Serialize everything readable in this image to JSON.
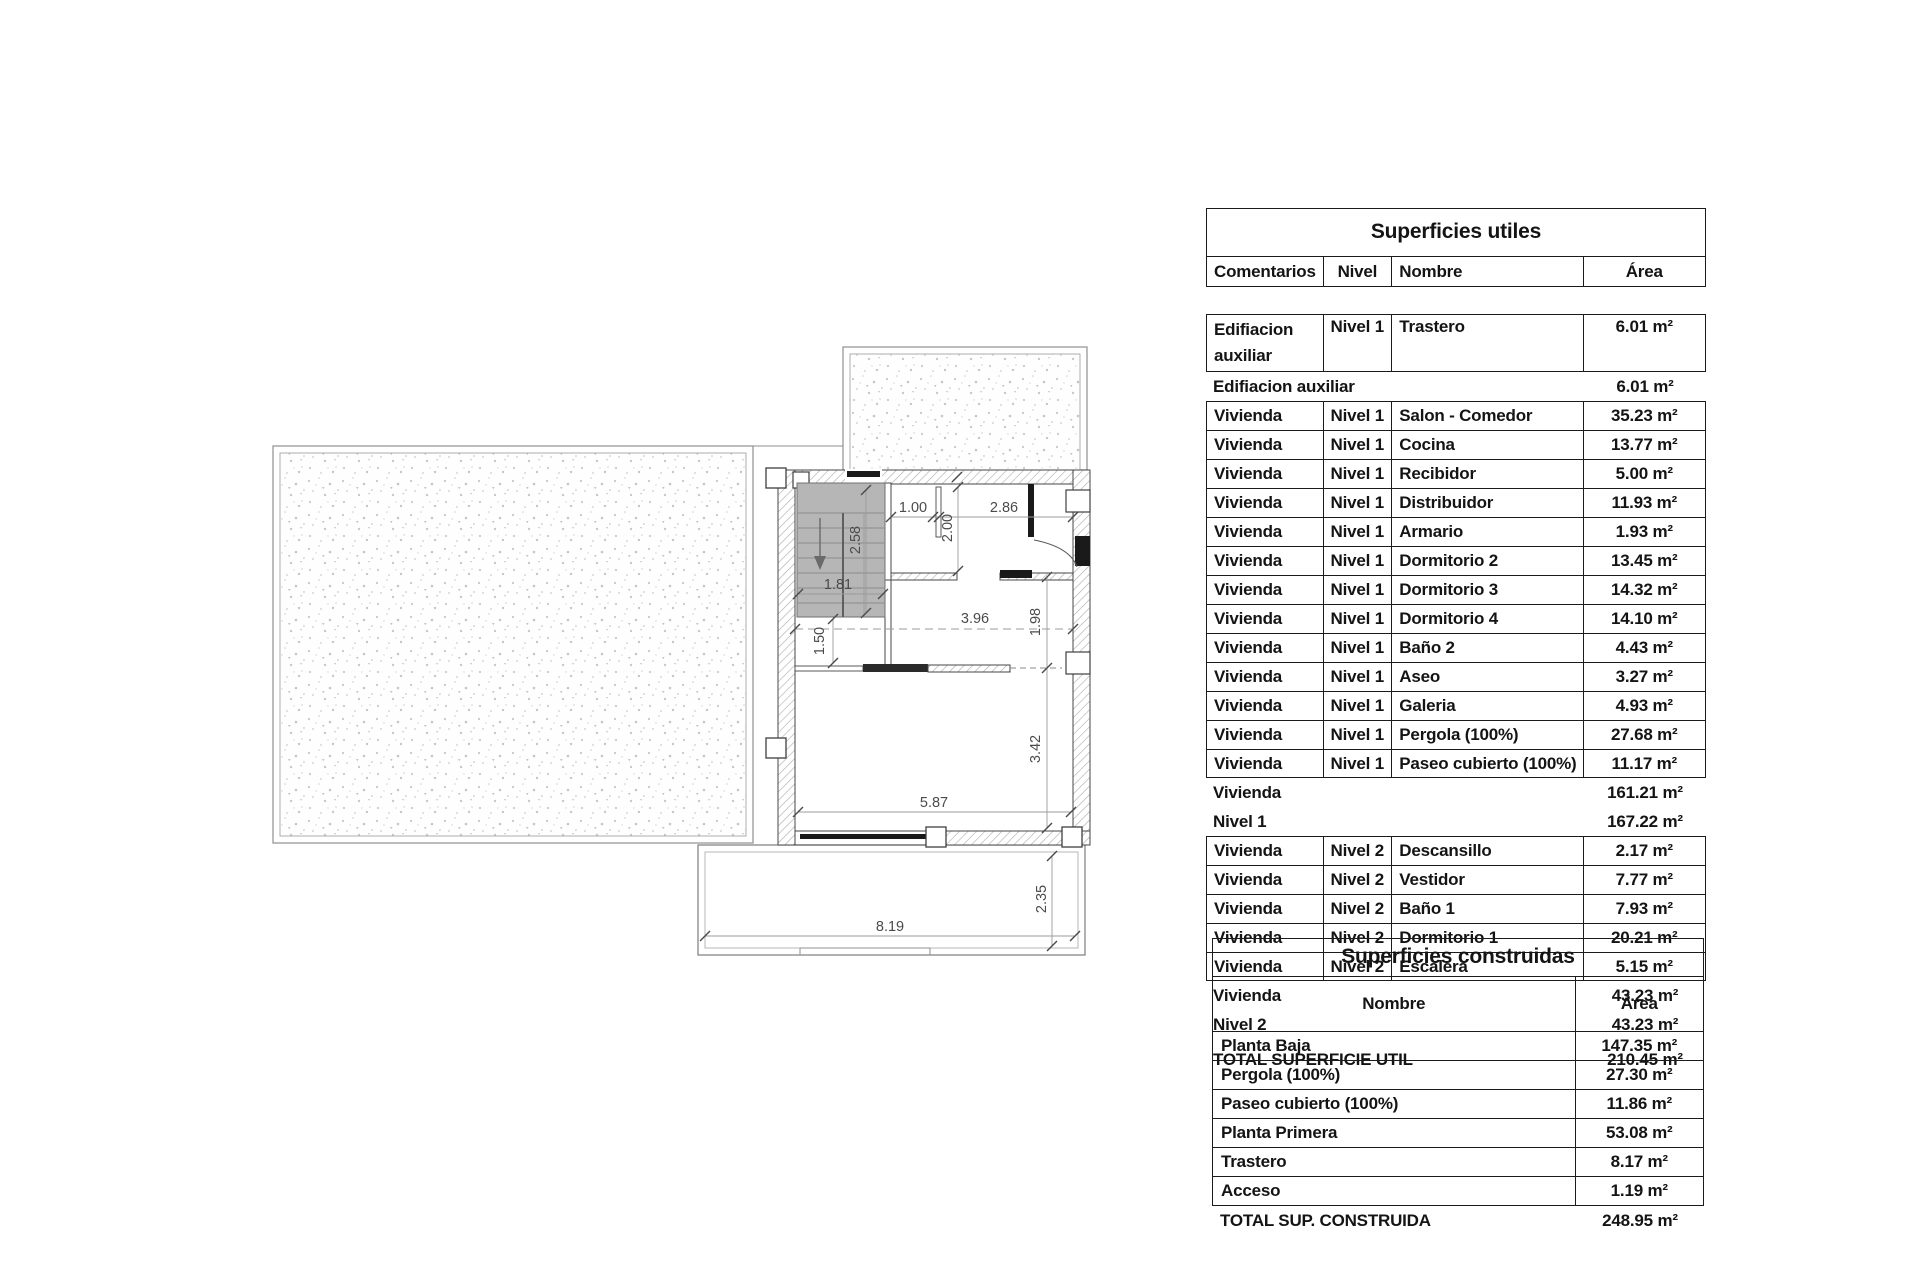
{
  "plan": {
    "dimensions": {
      "closet_width": "1.00",
      "bedroom_width": "2.86",
      "bedroom_depth": "2.00",
      "stair_run": "2.58",
      "stair_width": "1.81",
      "landing_depth": "1.50",
      "hall_width": "3.96",
      "hall_depth": "1.98",
      "salon_depth": "3.42",
      "salon_width": "5.87",
      "porch_width": "8.19",
      "porch_depth": "2.35"
    }
  },
  "tables": {
    "superficies_utiles": {
      "title": "Superficies utiles",
      "columns": [
        "Comentarios",
        "Nivel",
        "Nombre",
        "Área"
      ],
      "rows": [
        {
          "type": "data",
          "tall": true,
          "comentarios": "Edifiacion auxiliar",
          "nivel": "Nivel 1",
          "nombre": "Trastero",
          "area": "6.01 m²"
        },
        {
          "type": "subtotal",
          "label": "Edifiacion auxiliar",
          "area": "6.01 m²"
        },
        {
          "type": "data",
          "comentarios": "Vivienda",
          "nivel": "Nivel 1",
          "nombre": "Salon - Comedor",
          "area": "35.23 m²"
        },
        {
          "type": "data",
          "comentarios": "Vivienda",
          "nivel": "Nivel 1",
          "nombre": "Cocina",
          "area": "13.77 m²"
        },
        {
          "type": "data",
          "comentarios": "Vivienda",
          "nivel": "Nivel 1",
          "nombre": "Recibidor",
          "area": "5.00 m²"
        },
        {
          "type": "data",
          "comentarios": "Vivienda",
          "nivel": "Nivel 1",
          "nombre": "Distribuidor",
          "area": "11.93 m²"
        },
        {
          "type": "data",
          "comentarios": "Vivienda",
          "nivel": "Nivel 1",
          "nombre": "Armario",
          "area": "1.93 m²"
        },
        {
          "type": "data",
          "comentarios": "Vivienda",
          "nivel": "Nivel 1",
          "nombre": "Dormitorio 2",
          "area": "13.45 m²"
        },
        {
          "type": "data",
          "comentarios": "Vivienda",
          "nivel": "Nivel 1",
          "nombre": "Dormitorio 3",
          "area": "14.32 m²"
        },
        {
          "type": "data",
          "comentarios": "Vivienda",
          "nivel": "Nivel 1",
          "nombre": "Dormitorio 4",
          "area": "14.10 m²"
        },
        {
          "type": "data",
          "comentarios": "Vivienda",
          "nivel": "Nivel 1",
          "nombre": "Baño 2",
          "area": "4.43 m²"
        },
        {
          "type": "data",
          "comentarios": "Vivienda",
          "nivel": "Nivel 1",
          "nombre": "Aseo",
          "area": "3.27 m²"
        },
        {
          "type": "data",
          "comentarios": "Vivienda",
          "nivel": "Nivel 1",
          "nombre": "Galeria",
          "area": "4.93 m²"
        },
        {
          "type": "data",
          "comentarios": "Vivienda",
          "nivel": "Nivel 1",
          "nombre": "Pergola (100%)",
          "area": "27.68 m²"
        },
        {
          "type": "data",
          "comentarios": "Vivienda",
          "nivel": "Nivel 1",
          "nombre": "Paseo cubierto (100%)",
          "area": "11.17 m²"
        },
        {
          "type": "subtotal",
          "label": "Vivienda",
          "area": "161.21 m²"
        },
        {
          "type": "subtotal",
          "label": "Nivel 1",
          "area": "167.22 m²"
        },
        {
          "type": "data",
          "comentarios": "Vivienda",
          "nivel": "Nivel 2",
          "nombre": "Descansillo",
          "area": "2.17 m²"
        },
        {
          "type": "data",
          "comentarios": "Vivienda",
          "nivel": "Nivel 2",
          "nombre": "Vestidor",
          "area": "7.77 m²"
        },
        {
          "type": "data",
          "comentarios": "Vivienda",
          "nivel": "Nivel 2",
          "nombre": "Baño 1",
          "area": "7.93 m²"
        },
        {
          "type": "data",
          "comentarios": "Vivienda",
          "nivel": "Nivel 2",
          "nombre": "Dormitorio 1",
          "area": "20.21 m²"
        },
        {
          "type": "data",
          "comentarios": "Vivienda",
          "nivel": "Nivel 2",
          "nombre": "Escalera",
          "area": "5.15 m²"
        },
        {
          "type": "subtotal",
          "label": "Vivienda",
          "area": "43.23 m²"
        },
        {
          "type": "subtotal",
          "label": "Nivel 2",
          "area": "43.23 m²"
        },
        {
          "type": "total",
          "label": "TOTAL SUPERFICIE UTIL",
          "area": "210.45 m²"
        }
      ]
    },
    "superficies_construidas": {
      "title": "Superficies construidas",
      "columns": [
        "Nombre",
        "Área"
      ],
      "rows": [
        {
          "nombre": "Planta Baja",
          "area": "147.35 m²"
        },
        {
          "nombre": "Pergola (100%)",
          "area": "27.30 m²"
        },
        {
          "nombre": "Paseo cubierto (100%)",
          "area": "11.86 m²"
        },
        {
          "nombre": "Planta Primera",
          "area": "53.08 m²"
        },
        {
          "nombre": "Trastero",
          "area": "8.17 m²"
        },
        {
          "nombre": "Acceso",
          "area": "1.19 m²"
        }
      ],
      "total": {
        "label": "TOTAL SUP. CONSTRUIDA",
        "area": "248.95 m²"
      }
    }
  }
}
